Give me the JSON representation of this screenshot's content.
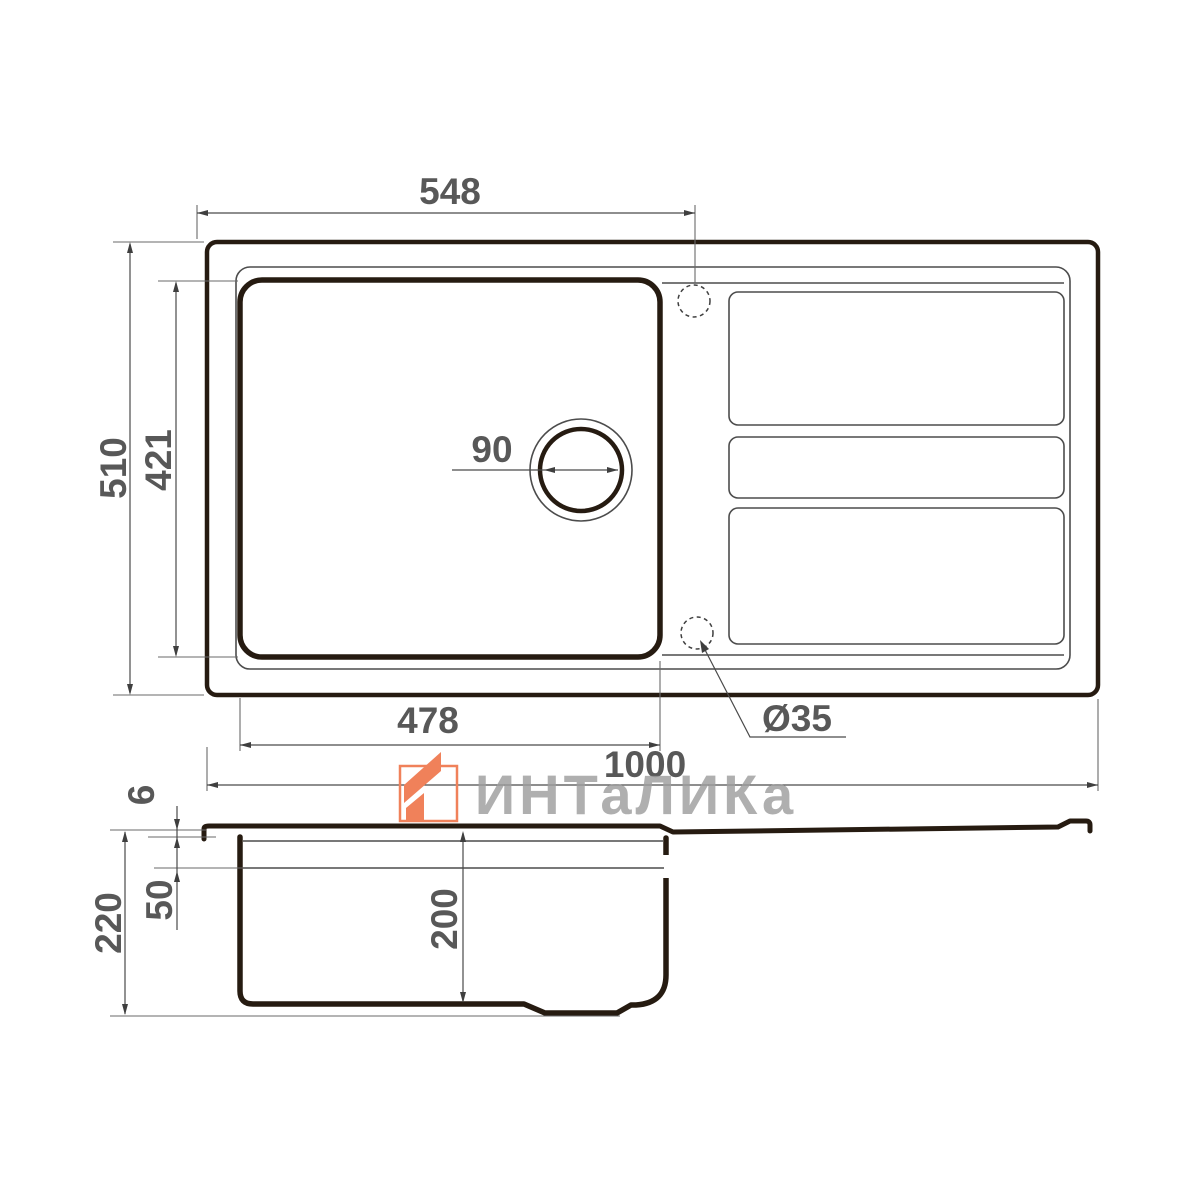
{
  "watermark": {
    "brand": "ИНТаЛИКа"
  },
  "top_view": {
    "label": "sink top view",
    "dims": {
      "width_to_tap_hole": "548",
      "overall_depth": "510",
      "bowl_inner_depth": "421",
      "drain_diameter": "90",
      "bowl_inner_width": "478",
      "overall_width": "1000",
      "tap_hole_diameter": "Ø35"
    }
  },
  "section_view": {
    "label": "sink section view",
    "dims": {
      "rim_height": "6",
      "ledge_depth": "50",
      "overall_height": "220",
      "bowl_depth": "200"
    }
  },
  "colors": {
    "line_dark": "#261b11",
    "line_thin": "#4c4c4c",
    "dim_text": "#585858",
    "watermark_orange": "#F0815A",
    "watermark_gray": "#9E9E9E"
  }
}
